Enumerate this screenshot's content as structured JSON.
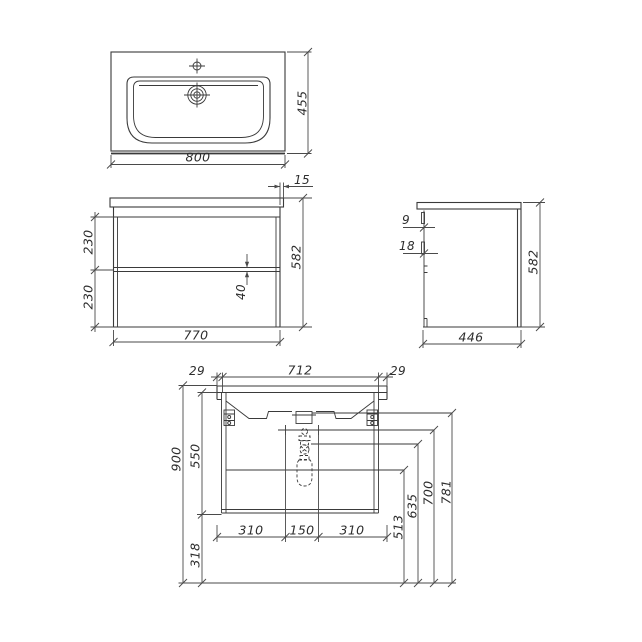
{
  "drawing": {
    "type": "technical-drawing-vanity-unit",
    "line_color": "#3a3a3a",
    "background": "#ffffff",
    "dims": {
      "top_view": {
        "width": "800",
        "depth": "455"
      },
      "front_view": {
        "countertop_overhang": "15",
        "upper_drawer_height": "230",
        "lower_drawer_height": "230",
        "drawer_gap": "40",
        "height": "582",
        "width": "770"
      },
      "side_view": {
        "top_reveal": "9",
        "front_panel_thickness": "18",
        "height": "582",
        "depth": "446"
      },
      "installation_view": {
        "left_margin": "29",
        "mounting_span": "712",
        "right_margin": "29",
        "overall_height": "900",
        "carcass_height": "550",
        "floor_clearance": "318",
        "bottom_left": "310",
        "bottom_center": "150",
        "bottom_right": "310",
        "level_513": "513",
        "level_635": "635",
        "level_700": "700",
        "level_781": "781"
      }
    }
  }
}
